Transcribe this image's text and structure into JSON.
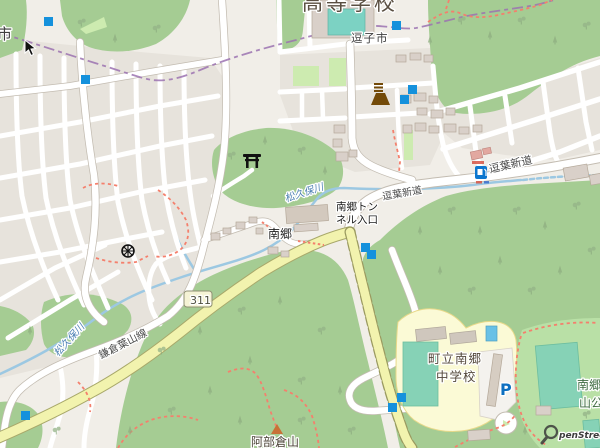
{
  "map": {
    "attribution": {
      "text": "penStreetMap"
    },
    "colors": {
      "background": "#f1eee8",
      "residential_block": "#e7e3dc",
      "forest_green": "#a5cc93",
      "park_green": "#b9e0a6",
      "grass_green": "#cdebb0",
      "pitch_teal": "#86d2b6",
      "water_blue": "#9cc8e2",
      "road_yellow": "#f2f3ae",
      "road_yellow_casing": "#a8a86a",
      "boundary_purple": "#9b72b0",
      "path_red": "#f4806d",
      "marker_blue": "#1591dc",
      "transport_blue": "#0d77cf",
      "poi_brown": "#734a08"
    },
    "route_shield": {
      "ref": "311"
    },
    "labels": [
      {
        "id": "school-top",
        "text": "高等学校",
        "x": 302,
        "y": 10,
        "size": 21,
        "color": "#5a4f42",
        "ls": 3
      },
      {
        "id": "zushi-city",
        "text": "逗子市",
        "x": 351,
        "y": 42,
        "size": 11.5,
        "color": "#3f3f3f",
        "ls": 1
      },
      {
        "id": "city-edge",
        "text": "市",
        "x": -3,
        "y": 39,
        "size": 15,
        "color": "#3f3f3f"
      },
      {
        "id": "tunnel-line1",
        "text": "南郷トン",
        "x": 336,
        "y": 210,
        "size": 10.5,
        "color": "#1d1d1d"
      },
      {
        "id": "tunnel-line2",
        "text": "ネル入口",
        "x": 336,
        "y": 223,
        "size": 10.5,
        "color": "#1d1d1d"
      },
      {
        "id": "nango",
        "text": "南郷",
        "x": 268,
        "y": 238,
        "size": 12,
        "color": "#1d1d1d"
      },
      {
        "id": "zuyo-shindo-w",
        "text": "逗葉新道",
        "x": 383,
        "y": 200,
        "size": 10,
        "color": "#4a4a4a",
        "rot": -10
      },
      {
        "id": "zuyo-shindo-e",
        "text": "逗葉新道",
        "x": 490,
        "y": 173,
        "size": 11,
        "color": "#4a4a4a",
        "rot": -13
      },
      {
        "id": "matsukubo-east",
        "text": "松久保川",
        "x": 286,
        "y": 202,
        "size": 10,
        "color": "#4d80b3",
        "rot": -18,
        "italic": true
      },
      {
        "id": "matsukubo-west",
        "text": "松久保川",
        "x": 58,
        "y": 357,
        "size": 10,
        "color": "#4d80b3",
        "rot": -48,
        "italic": true
      },
      {
        "id": "kamakura-hayama",
        "text": "鎌倉葉山線",
        "x": 101,
        "y": 359,
        "size": 10.5,
        "color": "#4a4a4a",
        "rot": -27
      },
      {
        "id": "shield-311",
        "text": "311",
        "x": 190,
        "y": 304,
        "size": 11,
        "color": "#4e4e3e"
      },
      {
        "id": "chugakko-line1",
        "text": "町立南郷",
        "x": 428,
        "y": 363,
        "size": 12.5,
        "color": "#54493c",
        "ls": 1
      },
      {
        "id": "chugakko-line2",
        "text": "中学校",
        "x": 436,
        "y": 381,
        "size": 12.5,
        "color": "#54493c",
        "ls": 1
      },
      {
        "id": "abekura",
        "text": "阿部倉山",
        "x": 251,
        "y": 446,
        "size": 12,
        "color": "#4a4236"
      },
      {
        "id": "park-line1",
        "text": "南郷上",
        "x": 577,
        "y": 389,
        "size": 12,
        "color": "#3e6b41"
      },
      {
        "id": "park-line2",
        "text": "山公園",
        "x": 579,
        "y": 407,
        "size": 12,
        "color": "#3e6b41"
      },
      {
        "id": "parking",
        "text": "P",
        "x": 500,
        "y": 395,
        "size": 16,
        "color": "#0d6fc0",
        "bold": true
      },
      {
        "id": "osm-attribution",
        "text": "penStreetMap",
        "x": 559,
        "y": 438,
        "size": 9,
        "color": "#3c3c3c",
        "italic": true,
        "bold": true
      }
    ],
    "markers": [
      {
        "x": 44,
        "y": 17
      },
      {
        "x": 81,
        "y": 75
      },
      {
        "x": 392,
        "y": 21
      },
      {
        "x": 408,
        "y": 85
      },
      {
        "x": 400,
        "y": 95
      },
      {
        "x": 361,
        "y": 243
      },
      {
        "x": 367,
        "y": 250
      },
      {
        "x": 397,
        "y": 393
      },
      {
        "x": 388,
        "y": 403
      },
      {
        "x": 21,
        "y": 411
      }
    ],
    "icons": {
      "shinto_shrine": "torii",
      "buddhist_temple": "dharma-wheel",
      "monument": "obelisk",
      "fuel_station": "fuel-pump",
      "mountain_peak": "triangle",
      "parking": "P",
      "mouse_cursor": "arrow"
    }
  }
}
